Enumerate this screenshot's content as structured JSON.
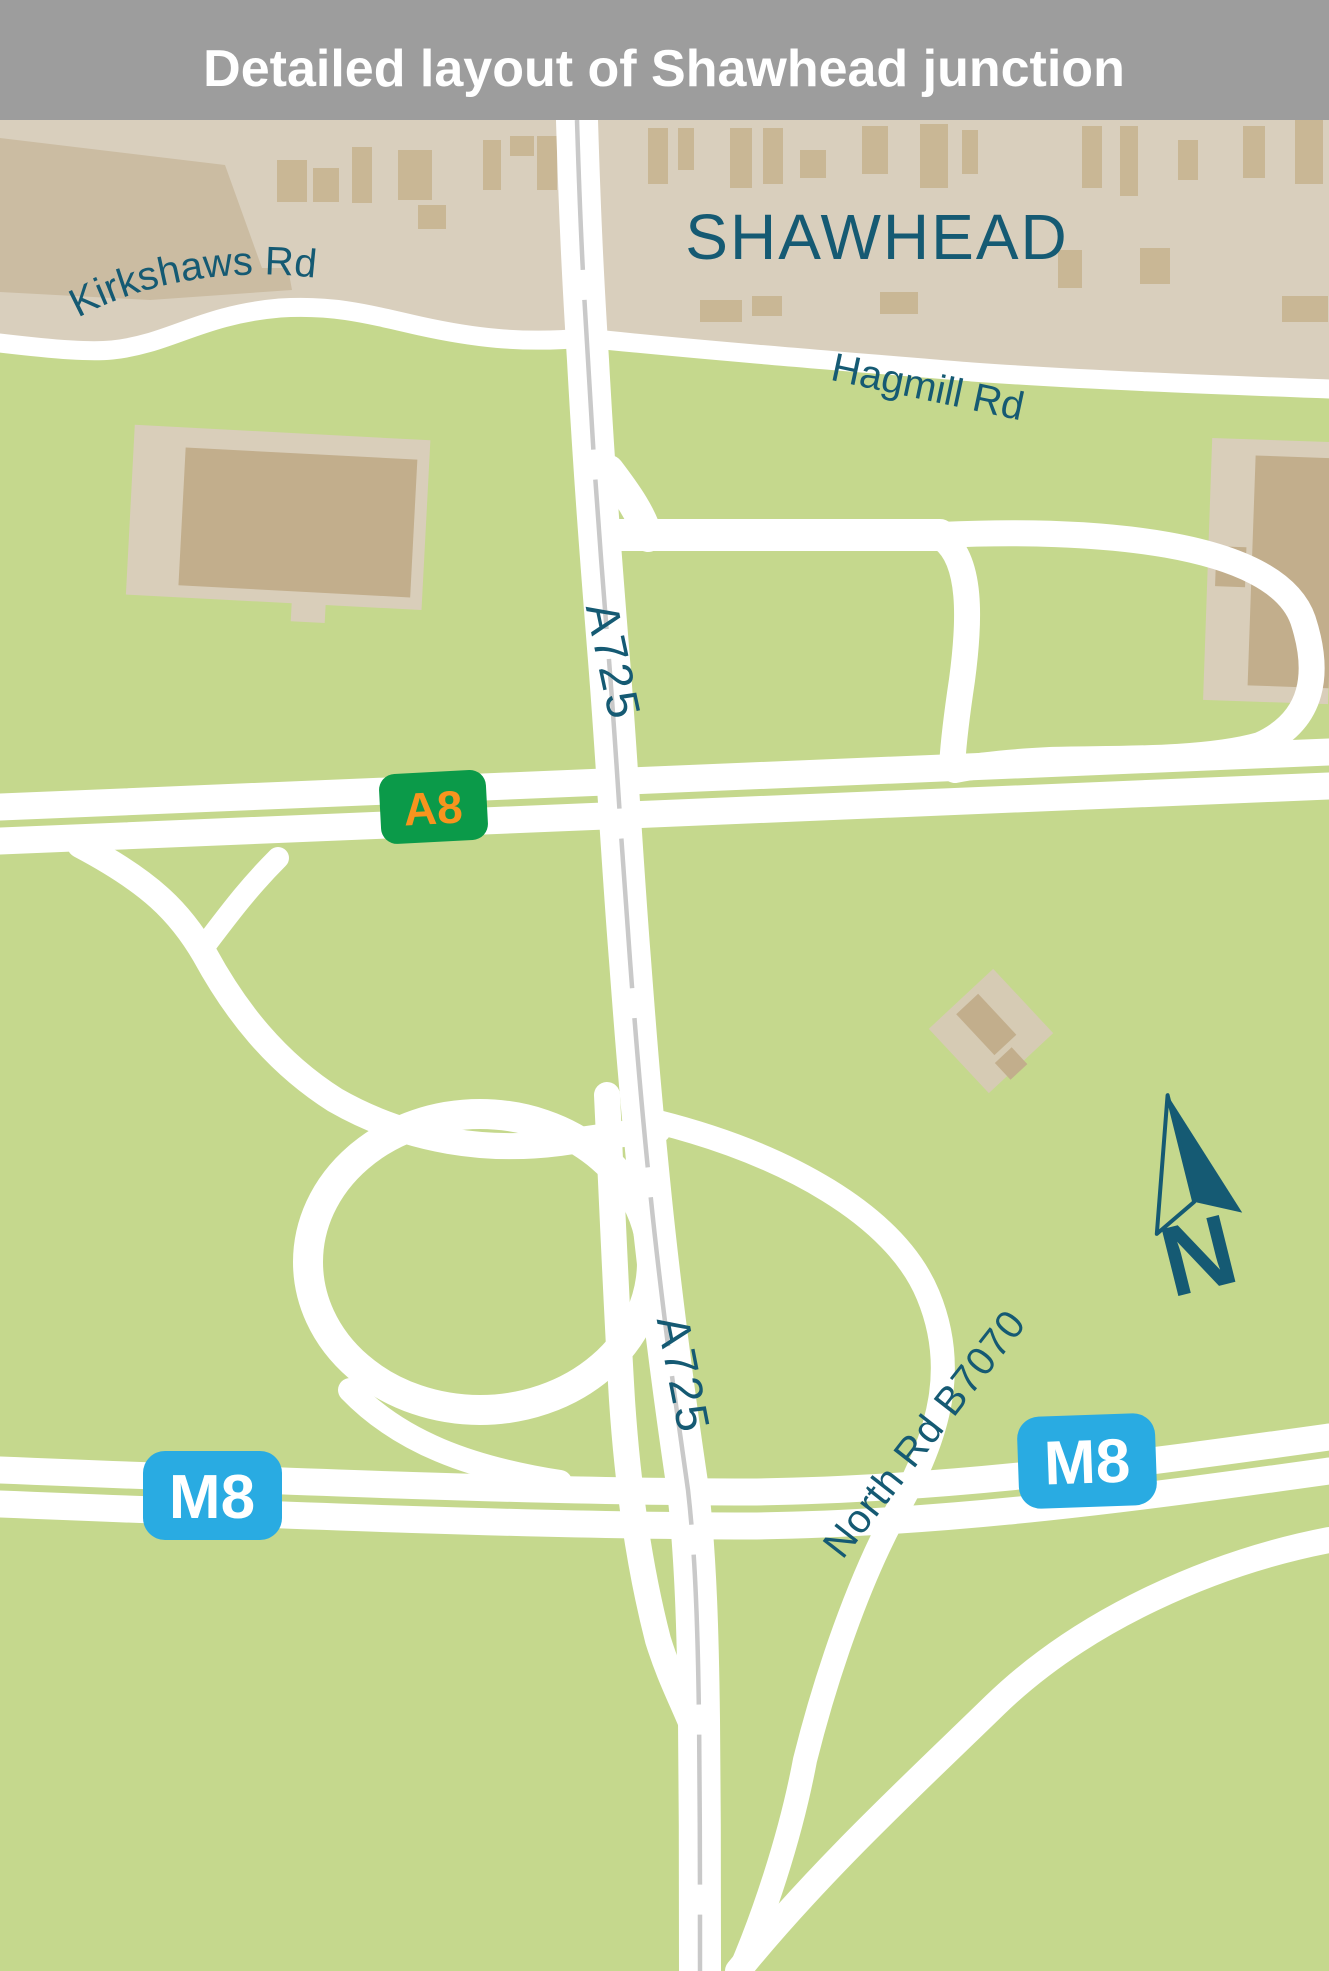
{
  "header": {
    "title": "Detailed layout of Shawhead junction"
  },
  "map": {
    "area_label": "SHAWHEAD",
    "roads": {
      "kirkshaws_rd": "Kirkshaws Rd",
      "hagmill_rd": "Hagmill Rd",
      "a725_label_upper": "A725",
      "a725_label_lower": "A725",
      "north_rd": "North Rd B7070"
    },
    "badges": {
      "a8": "A8",
      "m8_west": "M8",
      "m8_east": "M8"
    },
    "compass_label": "N",
    "colors": {
      "header_bg": "#9d9d9d",
      "header_text": "#ffffff",
      "field_green": "#c5d88d",
      "urban_tan": "#d9cfbd",
      "urban_tan_dark": "#cbbca2",
      "building_tan": "#c9b795",
      "building_inner": "#c2ae8c",
      "label_teal": "#155a73",
      "road_white": "#ffffff",
      "centerline_gray": "#c9c9c9",
      "a_road_badge_green": "#0b9a49",
      "a_road_text_orange": "#f7941e",
      "motorway_blue": "#29abe2"
    }
  }
}
